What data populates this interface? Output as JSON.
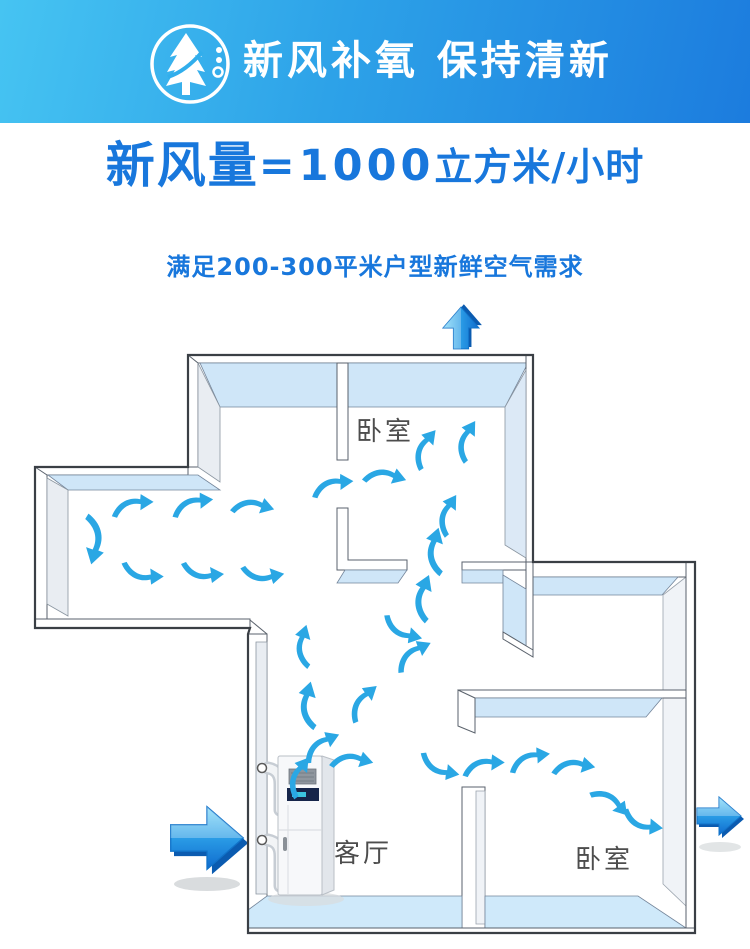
{
  "banner": {
    "title": "新风补氧 保持清新",
    "icon": "tree-arrow-icon",
    "bg_gradient": [
      "#46C4F2",
      "#1C7CDE"
    ],
    "text_color": "#FFFFFF"
  },
  "headline": {
    "prefix": "新风量",
    "value": "=1000",
    "unit": "立方米/小时",
    "color": "#1877DC"
  },
  "subheadline": {
    "text": "满足200-300平米户型新鲜空气需求"
  },
  "floorplan": {
    "rooms": [
      {
        "id": "bedroom-top",
        "label": "卧室"
      },
      {
        "id": "living-room",
        "label": "客厅"
      },
      {
        "id": "bedroom-bottom",
        "label": "卧室"
      }
    ],
    "device": {
      "name": "fresh-air-unit"
    },
    "colors": {
      "arrow": "#2AA7E4",
      "big_arrow_light": "#7FD9F8",
      "big_arrow_dark": "#0F6BCE",
      "wall_face_blue": "#CFE6F8",
      "wall_face_gray": "#E9EDF2",
      "floor_strip": "#CFE9FA",
      "outline": "#3A3F45"
    },
    "big_arrows": [
      {
        "id": "air-outlet-top",
        "direction": "up"
      },
      {
        "id": "air-inlet-left",
        "direction": "right"
      },
      {
        "id": "air-outlet-right",
        "direction": "right"
      }
    ],
    "airflow_arrows": [
      {
        "x": 133,
        "y": 507,
        "r": -6
      },
      {
        "x": 193,
        "y": 506,
        "r": -10
      },
      {
        "x": 253,
        "y": 508,
        "r": 12
      },
      {
        "x": 92,
        "y": 540,
        "r": 100,
        "s": 1.15
      },
      {
        "x": 143,
        "y": 572,
        "r": 4,
        "flip": true
      },
      {
        "x": 203,
        "y": 571,
        "r": 0,
        "flip": true
      },
      {
        "x": 263,
        "y": 573,
        "r": -6,
        "flip": true
      },
      {
        "x": 333,
        "y": 487,
        "r": -8
      },
      {
        "x": 385,
        "y": 478,
        "r": 14
      },
      {
        "x": 426,
        "y": 449,
        "r": -55
      },
      {
        "x": 468,
        "y": 441,
        "r": -62
      },
      {
        "x": 449,
        "y": 515,
        "r": -62
      },
      {
        "x": 437,
        "y": 551,
        "r": -78,
        "s": 1.1
      },
      {
        "x": 425,
        "y": 598,
        "r": -72,
        "s": 1.1
      },
      {
        "x": 403,
        "y": 629,
        "r": 18,
        "flip": true
      },
      {
        "x": 305,
        "y": 646,
        "r": -78
      },
      {
        "x": 414,
        "y": 656,
        "r": -30
      },
      {
        "x": 310,
        "y": 705,
        "r": -80,
        "s": 1.1
      },
      {
        "x": 364,
        "y": 703,
        "r": -45
      },
      {
        "x": 322,
        "y": 747,
        "r": -28
      },
      {
        "x": 300,
        "y": 777,
        "r": -58
      },
      {
        "x": 352,
        "y": 762,
        "r": 10
      },
      {
        "x": 440,
        "y": 766,
        "r": 16,
        "flip": true
      },
      {
        "x": 484,
        "y": 767,
        "r": -4
      },
      {
        "x": 530,
        "y": 761,
        "r": -12
      },
      {
        "x": 574,
        "y": 768,
        "r": 6
      },
      {
        "x": 610,
        "y": 803,
        "r": 44
      },
      {
        "x": 643,
        "y": 821,
        "r": 12,
        "flip": true
      }
    ]
  }
}
